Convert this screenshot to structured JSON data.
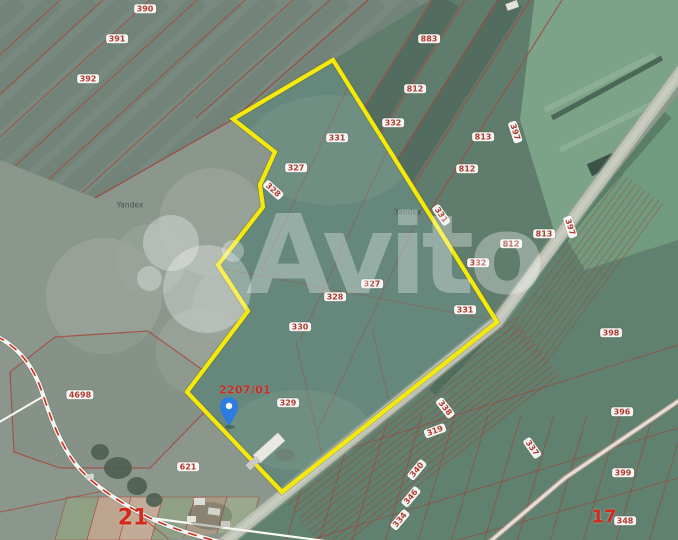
{
  "map": {
    "watermark": {
      "brand": "Avito"
    },
    "attribution": [
      {
        "text": "Yandex"
      },
      {
        "text": "Yandex"
      }
    ],
    "highlight": {
      "parcel_label": "2207/01"
    },
    "zone_labels": [
      {
        "text": "21"
      },
      {
        "text": "17"
      }
    ],
    "pin": {
      "x": 229,
      "y": 412
    },
    "colors": {
      "parcel_boundary": "#f4e90b",
      "cadastral_line": "#a5493f",
      "badge_text": "#b4392d",
      "zone_number": "#d6291d",
      "pin_blue": "#2e7ce1",
      "watermark_white": "#ffffff"
    },
    "parcel_labels": [
      {
        "text": "390",
        "x": 145,
        "y": 9,
        "rot": 0
      },
      {
        "text": "391",
        "x": 117,
        "y": 39,
        "rot": 0
      },
      {
        "text": "392",
        "x": 88,
        "y": 79,
        "rot": 0
      },
      {
        "text": "883",
        "x": 429,
        "y": 39,
        "rot": 0
      },
      {
        "text": "812",
        "x": 415,
        "y": 89,
        "rot": 0
      },
      {
        "text": "332",
        "x": 393,
        "y": 123,
        "rot": 0
      },
      {
        "text": "331",
        "x": 337,
        "y": 138,
        "rot": 0
      },
      {
        "text": "327",
        "x": 296,
        "y": 168,
        "rot": 0
      },
      {
        "text": "328",
        "x": 273,
        "y": 190,
        "rot": 42
      },
      {
        "text": "813",
        "x": 483,
        "y": 137,
        "rot": 0
      },
      {
        "text": "397",
        "x": 515,
        "y": 132,
        "rot": 72
      },
      {
        "text": "812",
        "x": 467,
        "y": 169,
        "rot": 0
      },
      {
        "text": "331",
        "x": 441,
        "y": 215,
        "rot": 55
      },
      {
        "text": "813",
        "x": 544,
        "y": 234,
        "rot": 0
      },
      {
        "text": "812",
        "x": 511,
        "y": 244,
        "rot": 0
      },
      {
        "text": "397",
        "x": 570,
        "y": 227,
        "rot": 72
      },
      {
        "text": "332",
        "x": 478,
        "y": 263,
        "rot": 0
      },
      {
        "text": "327",
        "x": 372,
        "y": 284,
        "rot": 0
      },
      {
        "text": "328",
        "x": 335,
        "y": 297,
        "rot": 0
      },
      {
        "text": "331",
        "x": 465,
        "y": 310,
        "rot": 0
      },
      {
        "text": "330",
        "x": 300,
        "y": 327,
        "rot": 0
      },
      {
        "text": "398",
        "x": 611,
        "y": 333,
        "rot": 0
      },
      {
        "text": "4698",
        "x": 80,
        "y": 395,
        "rot": 0
      },
      {
        "text": "329",
        "x": 288,
        "y": 403,
        "rot": 0
      },
      {
        "text": "621",
        "x": 188,
        "y": 467,
        "rot": 0
      },
      {
        "text": "338",
        "x": 445,
        "y": 408,
        "rot": 52
      },
      {
        "text": "319",
        "x": 435,
        "y": 431,
        "rot": -20
      },
      {
        "text": "337",
        "x": 532,
        "y": 448,
        "rot": 55
      },
      {
        "text": "340",
        "x": 417,
        "y": 470,
        "rot": -50
      },
      {
        "text": "346",
        "x": 411,
        "y": 497,
        "rot": -50
      },
      {
        "text": "334",
        "x": 400,
        "y": 520,
        "rot": -50
      },
      {
        "text": "396",
        "x": 622,
        "y": 412,
        "rot": 0
      },
      {
        "text": "399",
        "x": 623,
        "y": 473,
        "rot": 0
      },
      {
        "text": "348",
        "x": 625,
        "y": 521,
        "rot": 0
      }
    ]
  }
}
